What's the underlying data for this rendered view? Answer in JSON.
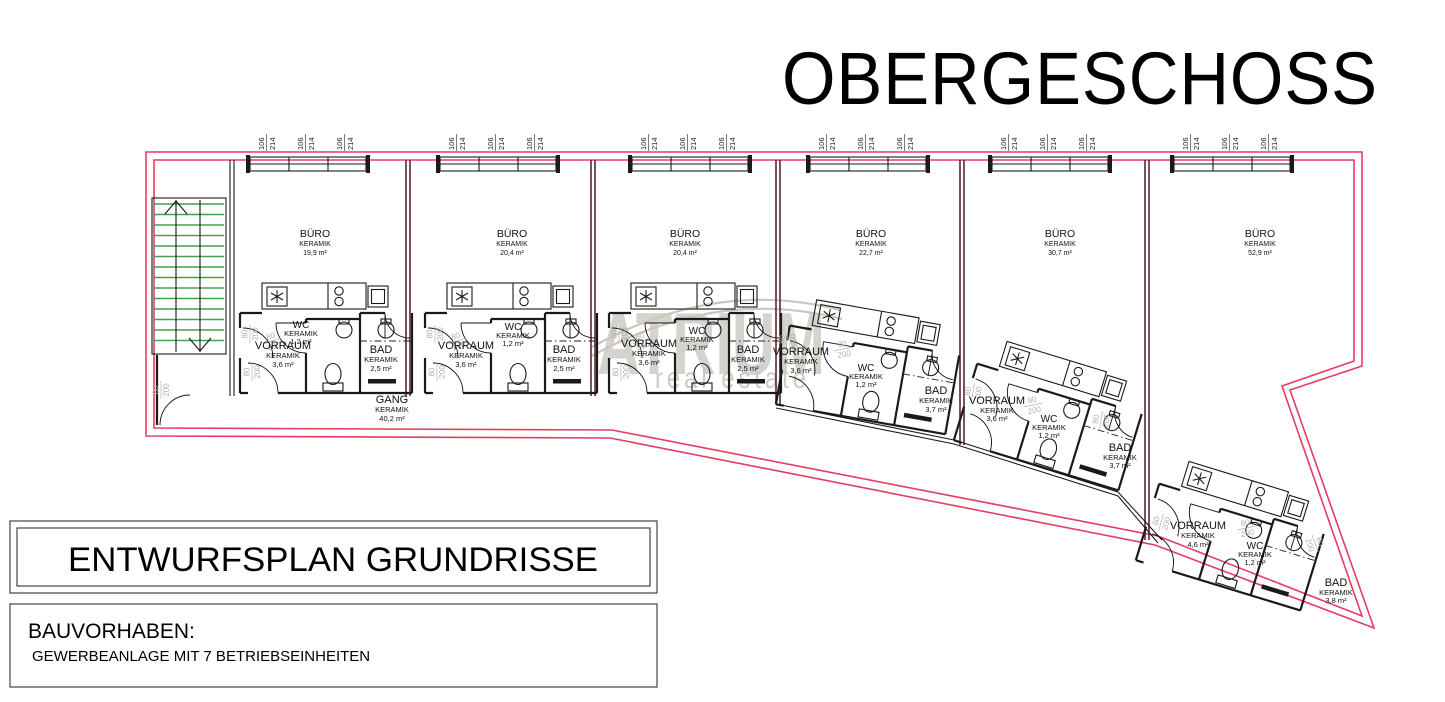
{
  "title": "OBERGESCHOSS",
  "watermark": {
    "brand": "ATRIUM",
    "tagline": "real estate"
  },
  "labels": {
    "window_dim_top": "106",
    "window_dim_bottom": "214",
    "door_dim_top": "80",
    "door_dim_bottom": "200"
  },
  "plan": {
    "offices": [
      {
        "name": "BÜRO",
        "material": "KERAMIK",
        "area": "19,9 m²"
      },
      {
        "name": "BÜRO",
        "material": "KERAMIK",
        "area": "20,4 m²"
      },
      {
        "name": "BÜRO",
        "material": "KERAMIK",
        "area": "20,4 m²"
      },
      {
        "name": "BÜRO",
        "material": "KERAMIK",
        "area": "22,7 m²"
      },
      {
        "name": "BÜRO",
        "material": "KERAMIK",
        "area": "30,7 m²"
      },
      {
        "name": "BÜRO",
        "material": "KERAMIK",
        "area": "52,9 m²"
      }
    ],
    "units": [
      {
        "vorraum": {
          "name": "VORRAUM",
          "material": "KERAMIK",
          "area": "3,6 m²"
        },
        "wc": {
          "name": "WC",
          "material": "KERAMIK",
          "area": "1,2 m²"
        },
        "bad": {
          "name": "BAD",
          "material": "KERAMIK",
          "area": "2,5 m²"
        }
      },
      {
        "vorraum": {
          "name": "VORRAUM",
          "material": "KERAMIK",
          "area": "3,6 m²"
        },
        "wc": {
          "name": "WC",
          "material": "KERAMIK",
          "area": "1,2 m²"
        },
        "bad": {
          "name": "BAD",
          "material": "KERAMIK",
          "area": "2,5 m²"
        }
      },
      {
        "vorraum": {
          "name": "VORRAUM",
          "material": "KERAMIK",
          "area": "3,6 m²"
        },
        "wc": {
          "name": "WC",
          "material": "KERAMIK",
          "area": "1,2 m²"
        },
        "bad": {
          "name": "BAD",
          "material": "KERAMIK",
          "area": "2,5 m²"
        }
      },
      {
        "vorraum": {
          "name": "VORRAUM",
          "material": "KERAMIK",
          "area": "3,6 m²"
        },
        "wc": {
          "name": "WC",
          "material": "KERAMIK",
          "area": "1,2 m²"
        },
        "bad": {
          "name": "BAD",
          "material": "KERAMIK",
          "area": "3,7 m²"
        }
      },
      {
        "vorraum": {
          "name": "VORRAUM",
          "material": "KERAMIK",
          "area": "3,6 m²"
        },
        "wc": {
          "name": "WC",
          "material": "KERAMIK",
          "area": "1,2 m²"
        },
        "bad": {
          "name": "BAD",
          "material": "KERAMIK",
          "area": "3,7 m²"
        }
      },
      {
        "vorraum": {
          "name": "VORRAUM",
          "material": "KERAMIK",
          "area": "4,6 m²"
        },
        "wc": {
          "name": "WC",
          "material": "KERAMIK",
          "area": "1,2 m²"
        },
        "bad": {
          "name": "BAD",
          "material": "KERAMIK",
          "area": "3,8 m²"
        }
      }
    ],
    "gang": {
      "name": "GANG",
      "material": "KERAMIK",
      "area": "40,2 m²"
    }
  },
  "title_block": {
    "title": "ENTWURFSPLAN GRUNDRISSE"
  },
  "project_block": {
    "label": "BAUVORHABEN:",
    "description": "GEWERBEANLAGE MIT 7 BETRIEBSEINHEITEN"
  },
  "colors": {
    "outline": "#e63b63",
    "stairs": "#44a04c",
    "walls": "#1a1a1a",
    "separator": "#5a2733",
    "dim_text": "#b3b0ac",
    "watermark": "#ccc8c1"
  }
}
